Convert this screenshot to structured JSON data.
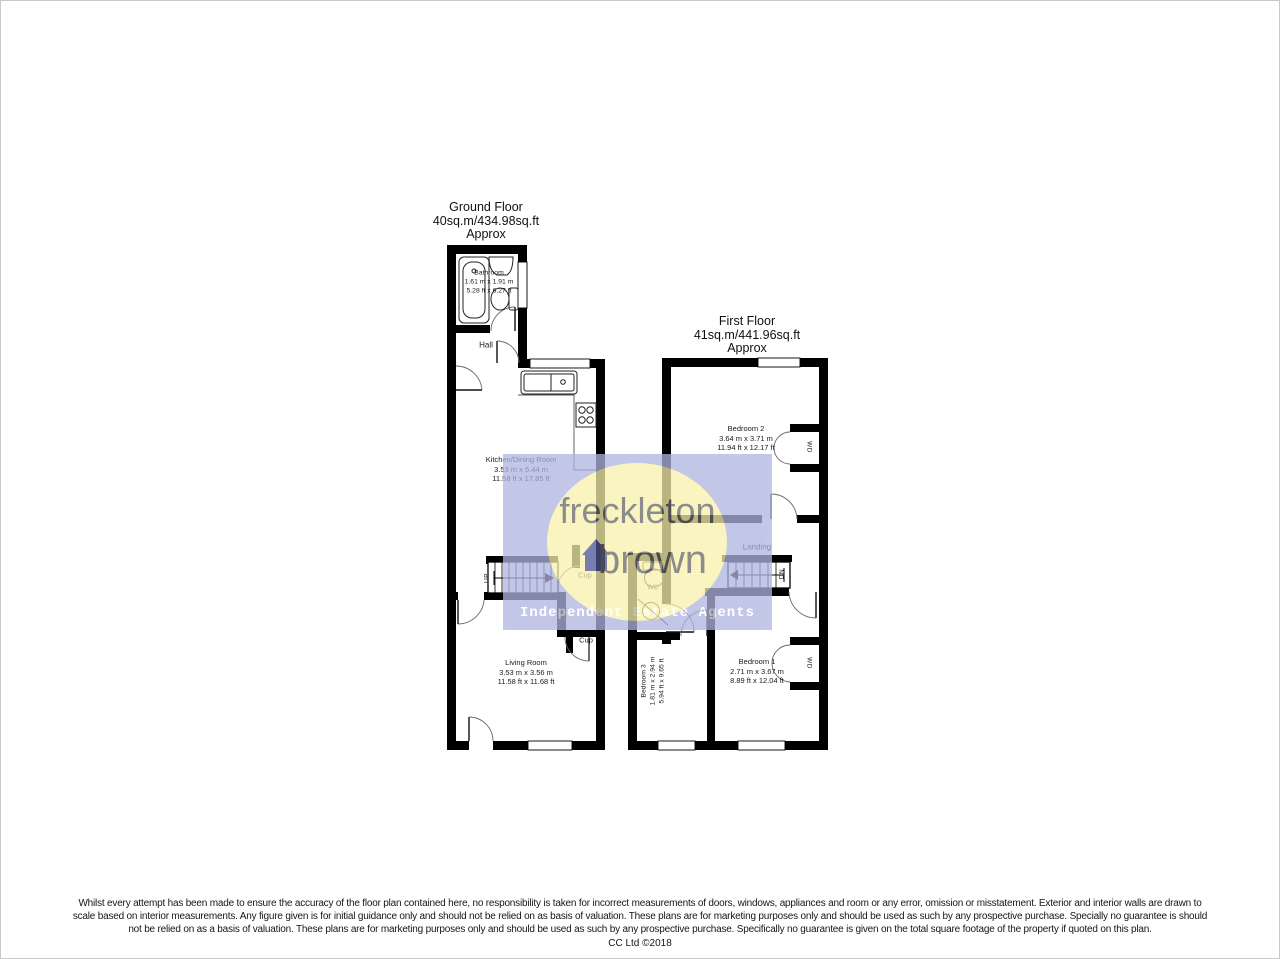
{
  "ground_floor": {
    "title": "Ground Floor",
    "area": "40sq.m/434.98sq.ft",
    "approx": "Approx",
    "bathroom": {
      "name": "Bathroom",
      "metric": "1.61 m x 1.91 m",
      "imperial": "5.28 ft x 6.27 ft"
    },
    "hall": {
      "name": "Hall"
    },
    "kitchen": {
      "name": "Kitchen/Dining Room",
      "metric": "3.53 m x 5.44 m",
      "imperial": "11.58 ft x 17.85 ft"
    },
    "living": {
      "name": "Living Room",
      "metric": "3.53 m x 3.56 m",
      "imperial": "11.58 ft x 11.68 ft"
    },
    "cupboard_upper": "Cup",
    "cupboard_lower": "Cup",
    "stairs_label": "UP"
  },
  "first_floor": {
    "title": "First Floor",
    "area": "41sq.m/441.96sq.ft",
    "approx": "Approx",
    "bedroom2": {
      "name": "Bedroom 2",
      "metric": "3.64 m x 3.71 m",
      "imperial": "11.94 ft x 12.17 ft"
    },
    "bedroom1": {
      "name": "Bedroom 1",
      "metric": "2.71 m x 3.67 m",
      "imperial": "8.89 ft x 12.04 ft"
    },
    "bedroom3": {
      "name": "Bedroom 3",
      "metric": "1.81 m x 2.94 m",
      "imperial": "5.94 ft x 9.65 ft"
    },
    "landing": "Landing",
    "wc": "WC",
    "wardrobe_bedroom2": "WD",
    "wardrobe_bedroom1": "WD",
    "stairs_label": "DN"
  },
  "watermark": {
    "brand_line1": "freckleton",
    "brand_line2": "brown",
    "tagline": "Independent Estate Agents",
    "square_color": "#b0b5e0",
    "circle_color": "#f8f1ab",
    "house_icon_color": "#4a5390"
  },
  "disclaimer": {
    "line1": "Whilst every attempt has been made to ensure the accuracy of the floor plan contained here, no responsibility is taken for incorrect measurements of doors, windows, appliances and room or any error, omission or misstatement. Exterior and interior walls are drawn to",
    "line2": "scale based on interior measurements. Any figure given is for initial guidance only and should not be relied on as basis of valuation. These plans are for marketing purposes only and should be used as such by any prospective purchase. Specially no guarantee is should",
    "line3": "not be relied on as a basis of valuation. These plans are for marketing purposes only and should be used as such by any prospective purchase. Specifically no guarantee is given on the total square footage of the property if quoted on this plan.",
    "credit": "CC Ltd ©2018"
  }
}
